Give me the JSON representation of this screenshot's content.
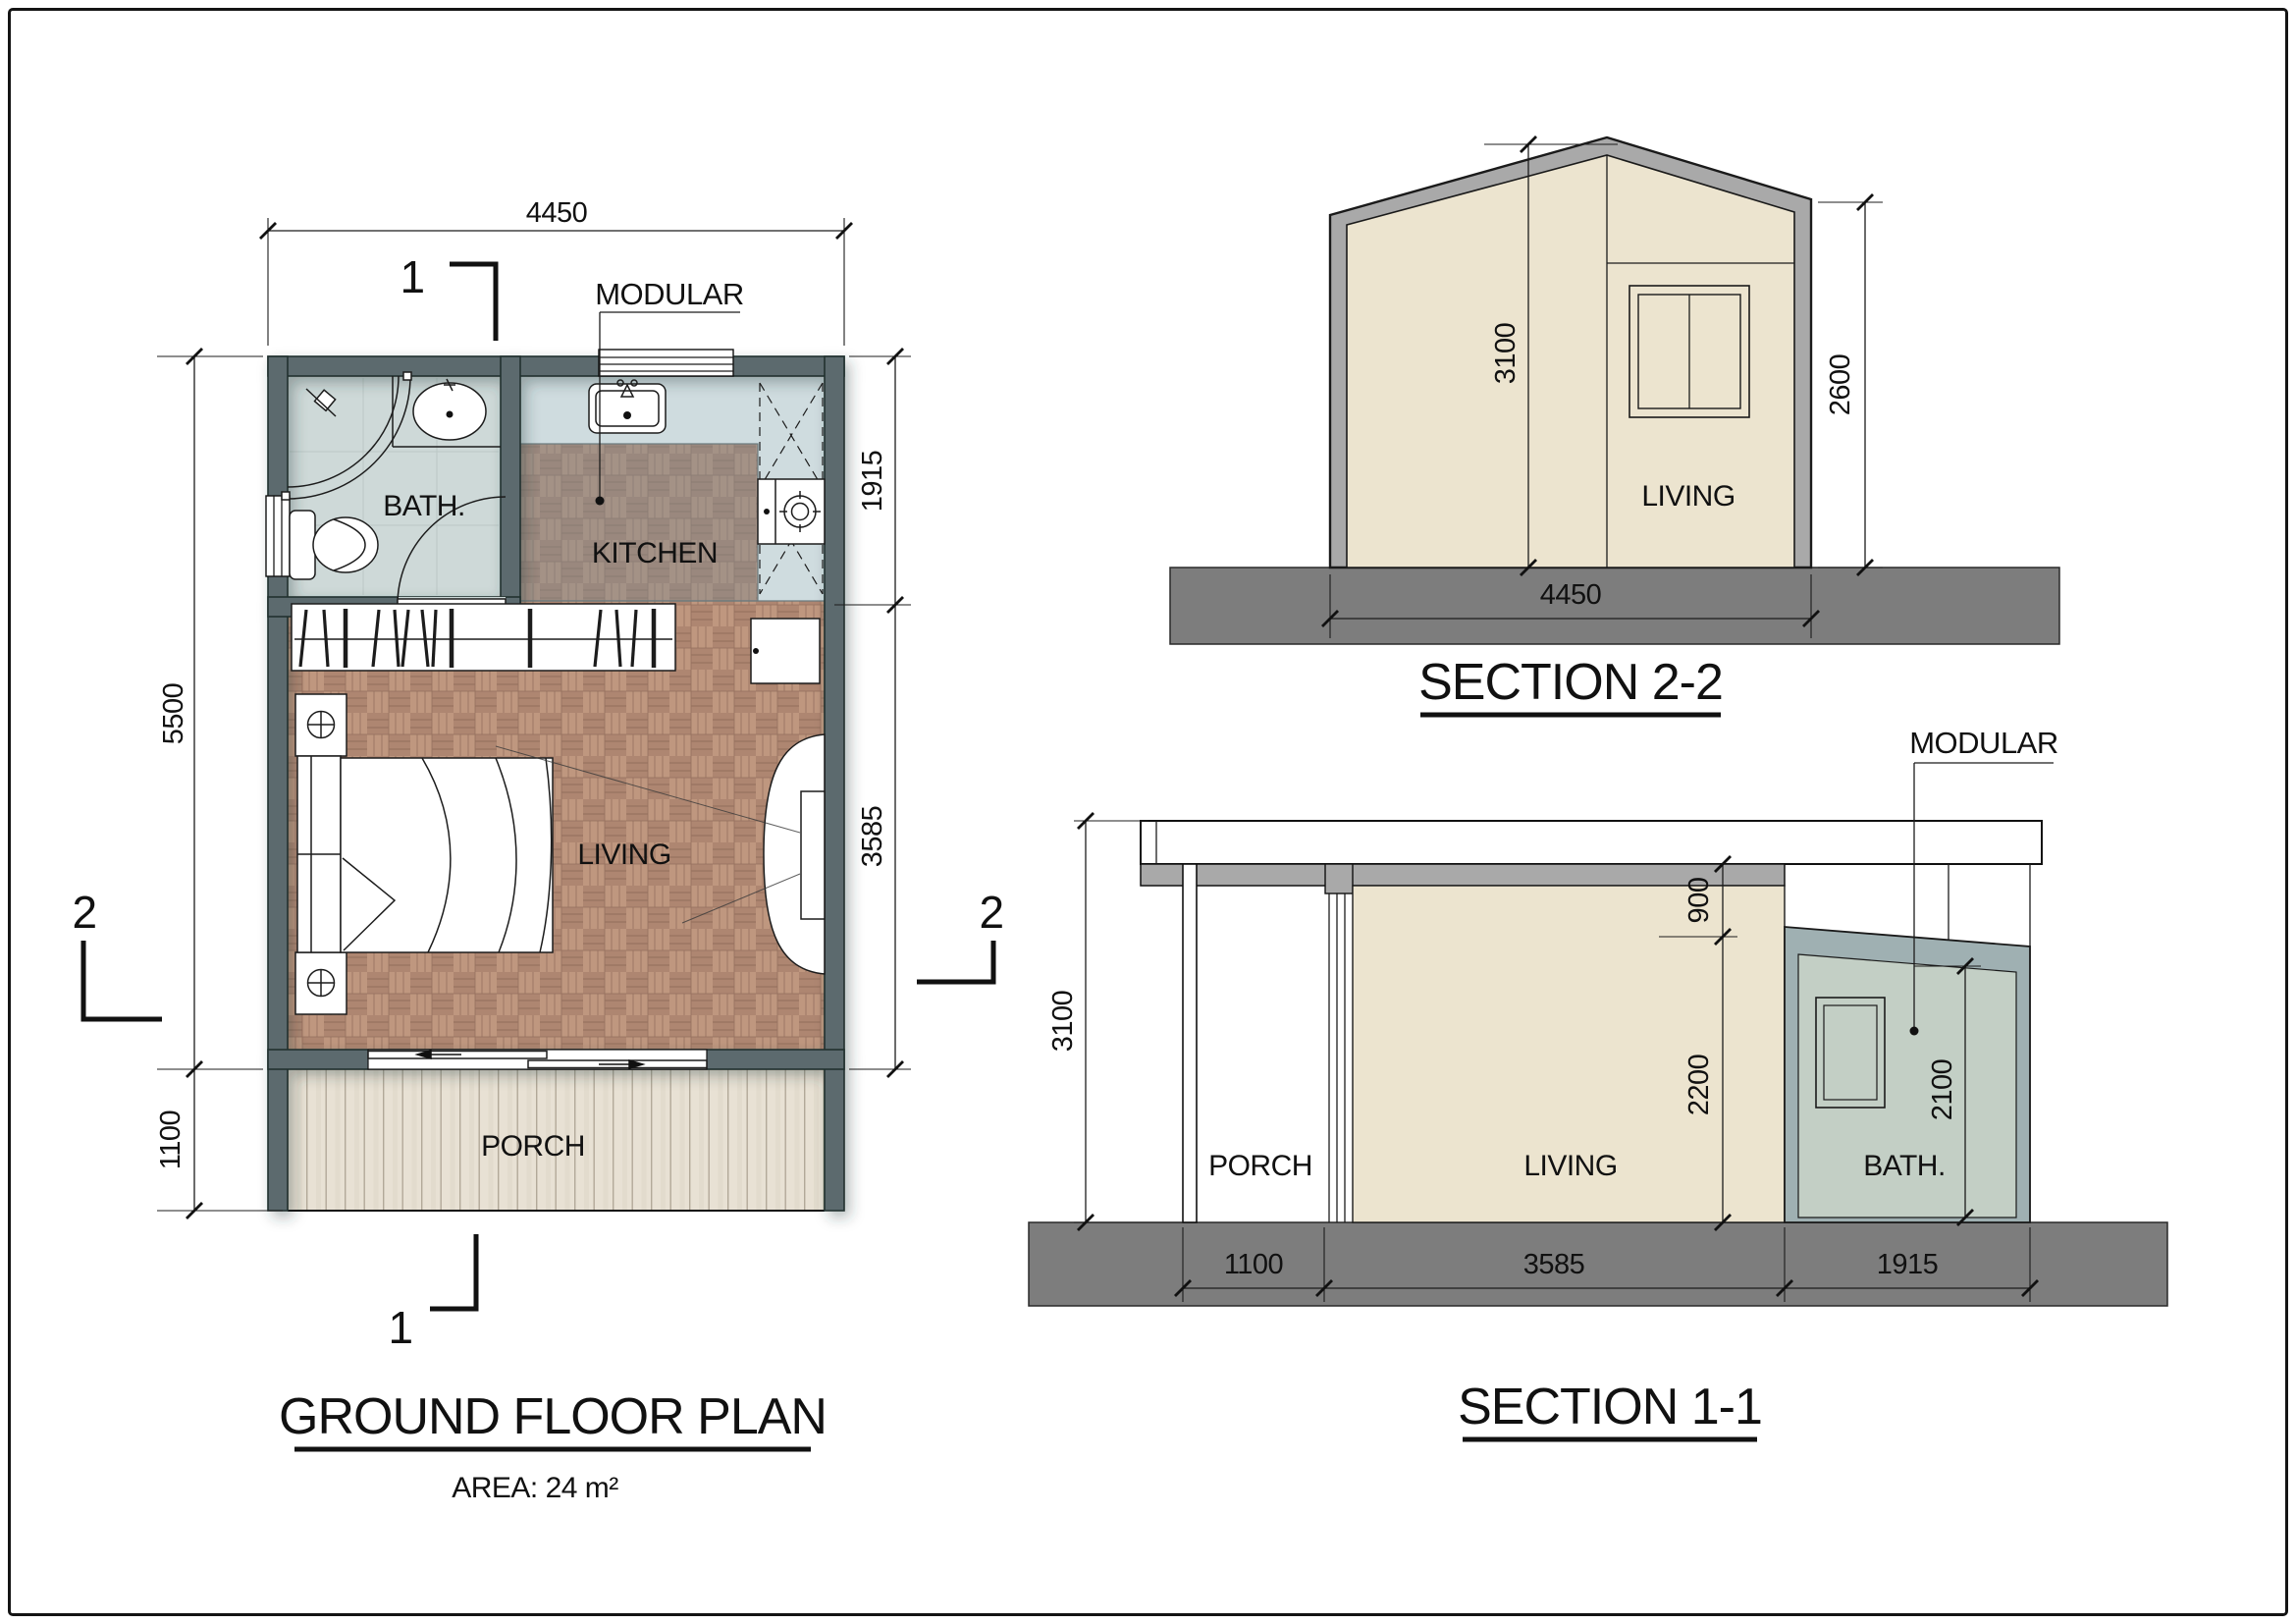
{
  "plan": {
    "title": "GROUND FLOOR PLAN",
    "area": "AREA: 24 m²",
    "modular": "MODULAR",
    "rooms": {
      "bath": "BATH.",
      "kitchen": "KITCHEN",
      "living": "LIVING",
      "porch": "PORCH"
    },
    "dims": {
      "width": "4450",
      "height": "5500",
      "porch": "1100",
      "kitchen_zone": "1915",
      "living_zone": "3585"
    },
    "markers": {
      "one": "1",
      "two": "2"
    }
  },
  "section22": {
    "title": "SECTION 2-2",
    "living": "LIVING",
    "dims": {
      "peak": "3100",
      "eave": "2600",
      "width": "4450"
    }
  },
  "section11": {
    "title": "SECTION 1-1",
    "modular": "MODULAR",
    "rooms": {
      "porch": "PORCH",
      "living": "LIVING",
      "bath": "BATH."
    },
    "dims": {
      "total": "3100",
      "drop": "900",
      "living": "2200",
      "bath": "2100",
      "porch_w": "1100",
      "living_w": "3585",
      "bath_w": "1915"
    }
  },
  "colors": {
    "wall": "#5b6a6e",
    "parquet": "#b58f79",
    "porch": "#e8e1d4",
    "bath_floor": "#ced9d8",
    "kitchen_floor": "#cfdcdf",
    "section_fill": "#ece4cf",
    "roof": "#a9a9a9",
    "ground": "#7d7d7d",
    "bath_module_wall": "#9fb0b2",
    "bath_module_fill": "#c3cfc5"
  }
}
